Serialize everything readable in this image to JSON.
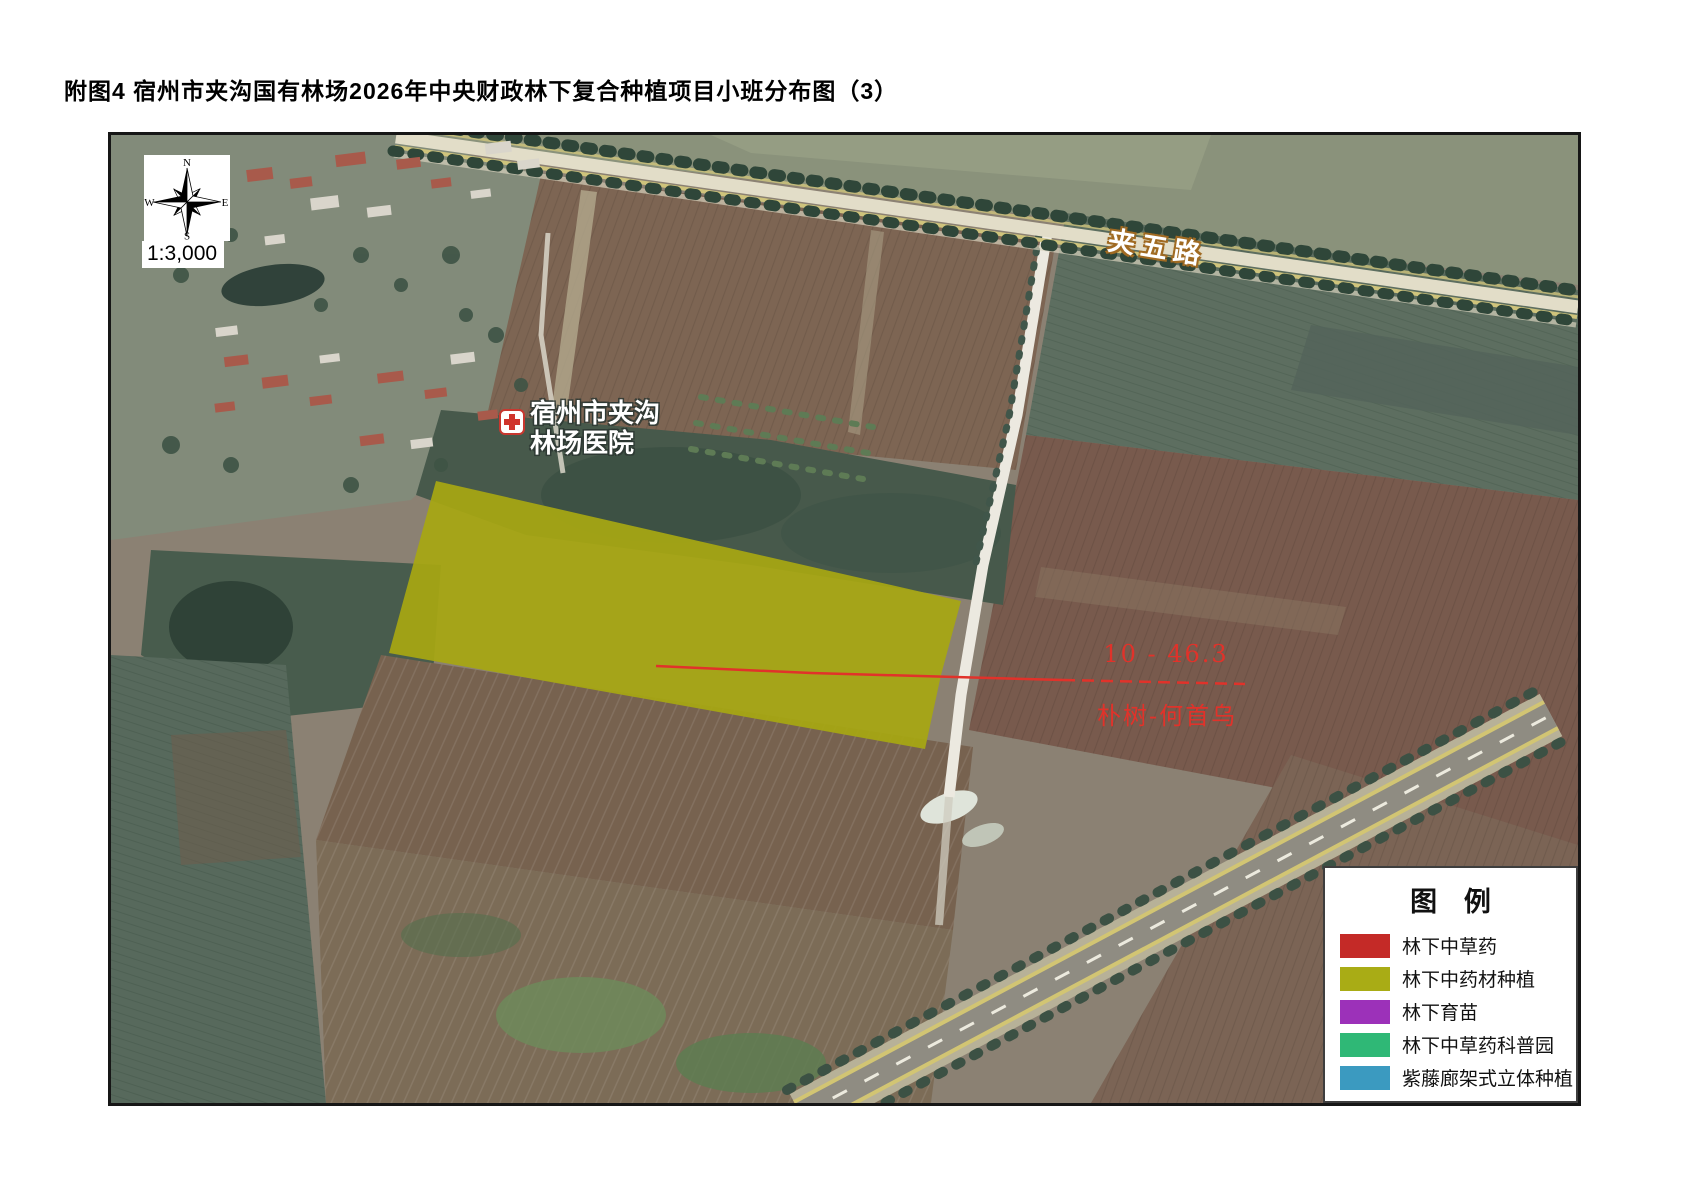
{
  "page": {
    "title": "附图4 宿州市夹沟国有林场2026年中央财政林下复合种植项目小班分布图（3）"
  },
  "map": {
    "scale_label": "1:3,000",
    "compass": {
      "n": "N",
      "s": "S",
      "e": "E",
      "w": "W"
    },
    "road_label": "夹五路",
    "hospital": {
      "name_line1": "宿州市夹沟",
      "name_line2": "林场医院"
    },
    "parcel_annotation": {
      "code": "10 - 46.3",
      "planting": "朴树-何首乌",
      "color": "#e1322a"
    },
    "parcel_fill": "#a7a712"
  },
  "legend": {
    "title": "图 例",
    "items": [
      {
        "label": "林下中草药",
        "color": "#c42a27"
      },
      {
        "label": "林下中药材种植",
        "color": "#a9ac15"
      },
      {
        "label": "林下育苗",
        "color": "#9c31b9"
      },
      {
        "label": "林下中草药科普园",
        "color": "#2fb876"
      },
      {
        "label": "紫藤廊架式立体种植",
        "color": "#3b9ac0"
      }
    ]
  }
}
